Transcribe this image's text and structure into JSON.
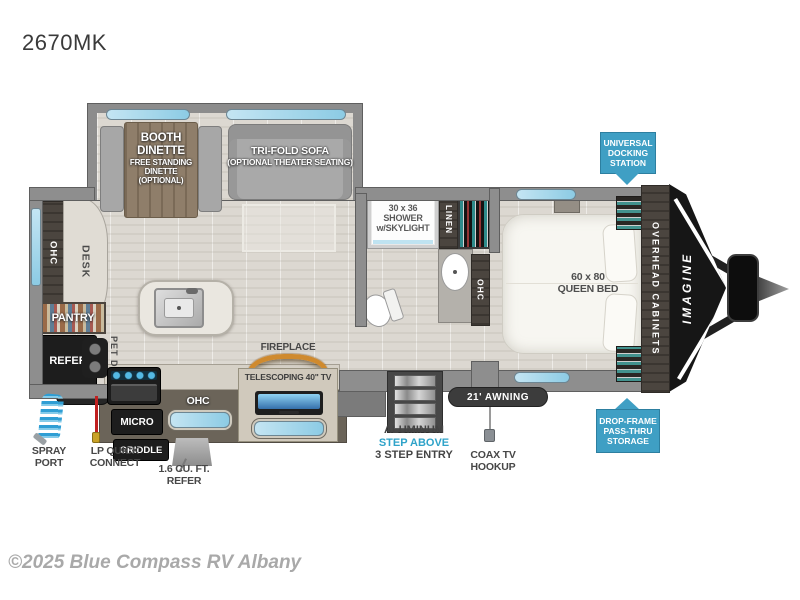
{
  "page": {
    "model": "2670MK",
    "copyright": "©2025 Blue Compass RV Albany"
  },
  "slide": {
    "dinette_title": "BOOTH\nDINETTE",
    "dinette_sub": "FREE STANDING\nDINETTE\n(OPTIONAL)",
    "sofa_title": "TRI-FOLD SOFA",
    "sofa_sub": "(OPTIONAL THEATER SEATING)"
  },
  "rear": {
    "ohc": "OHC",
    "desk": "DESK",
    "pantry": "PANTRY",
    "refer": "REFER",
    "pet_dish": "PET DISH"
  },
  "kitchen": {
    "micro": "MICRO",
    "ohc": "OHC",
    "griddle": "GRIDDLE",
    "exterior_refer": "1.6 CU. FT.\nREFER",
    "fireplace": "FIREPLACE",
    "tv": "TELESCOPING 40\" TV"
  },
  "bath": {
    "shower": "30 x 36\nSHOWER\nw/SKYLIGHT",
    "linen": "LINEN",
    "ohc": "OHC"
  },
  "bedroom": {
    "bed": "60 x 80\nQUEEN BED",
    "overhead": "OVERHEAD CABINETS"
  },
  "exterior": {
    "spray_port": "SPRAY\nPORT",
    "lp_quick": "LP QUICK\nCONNECT",
    "steps_1": "ALUMINUM",
    "steps_2": "STEP ABOVE",
    "steps_3": "3 STEP ENTRY",
    "coax": "COAX TV\nHOOKUP",
    "awning": "21' AWNING",
    "docking": "UNIVERSAL\nDOCKING\nSTATION",
    "storage": "DROP-FRAME\nPASS-THRU\nSTORAGE",
    "brand": "IMAGINE"
  },
  "colors": {
    "badge_blue": "#3f9fc4",
    "window_blue": "#a9d6e9",
    "accent_cyan": "#2fa3c9",
    "fireplace_orange": "#cf8a2e",
    "wall_gray": "#8e8e8e"
  }
}
